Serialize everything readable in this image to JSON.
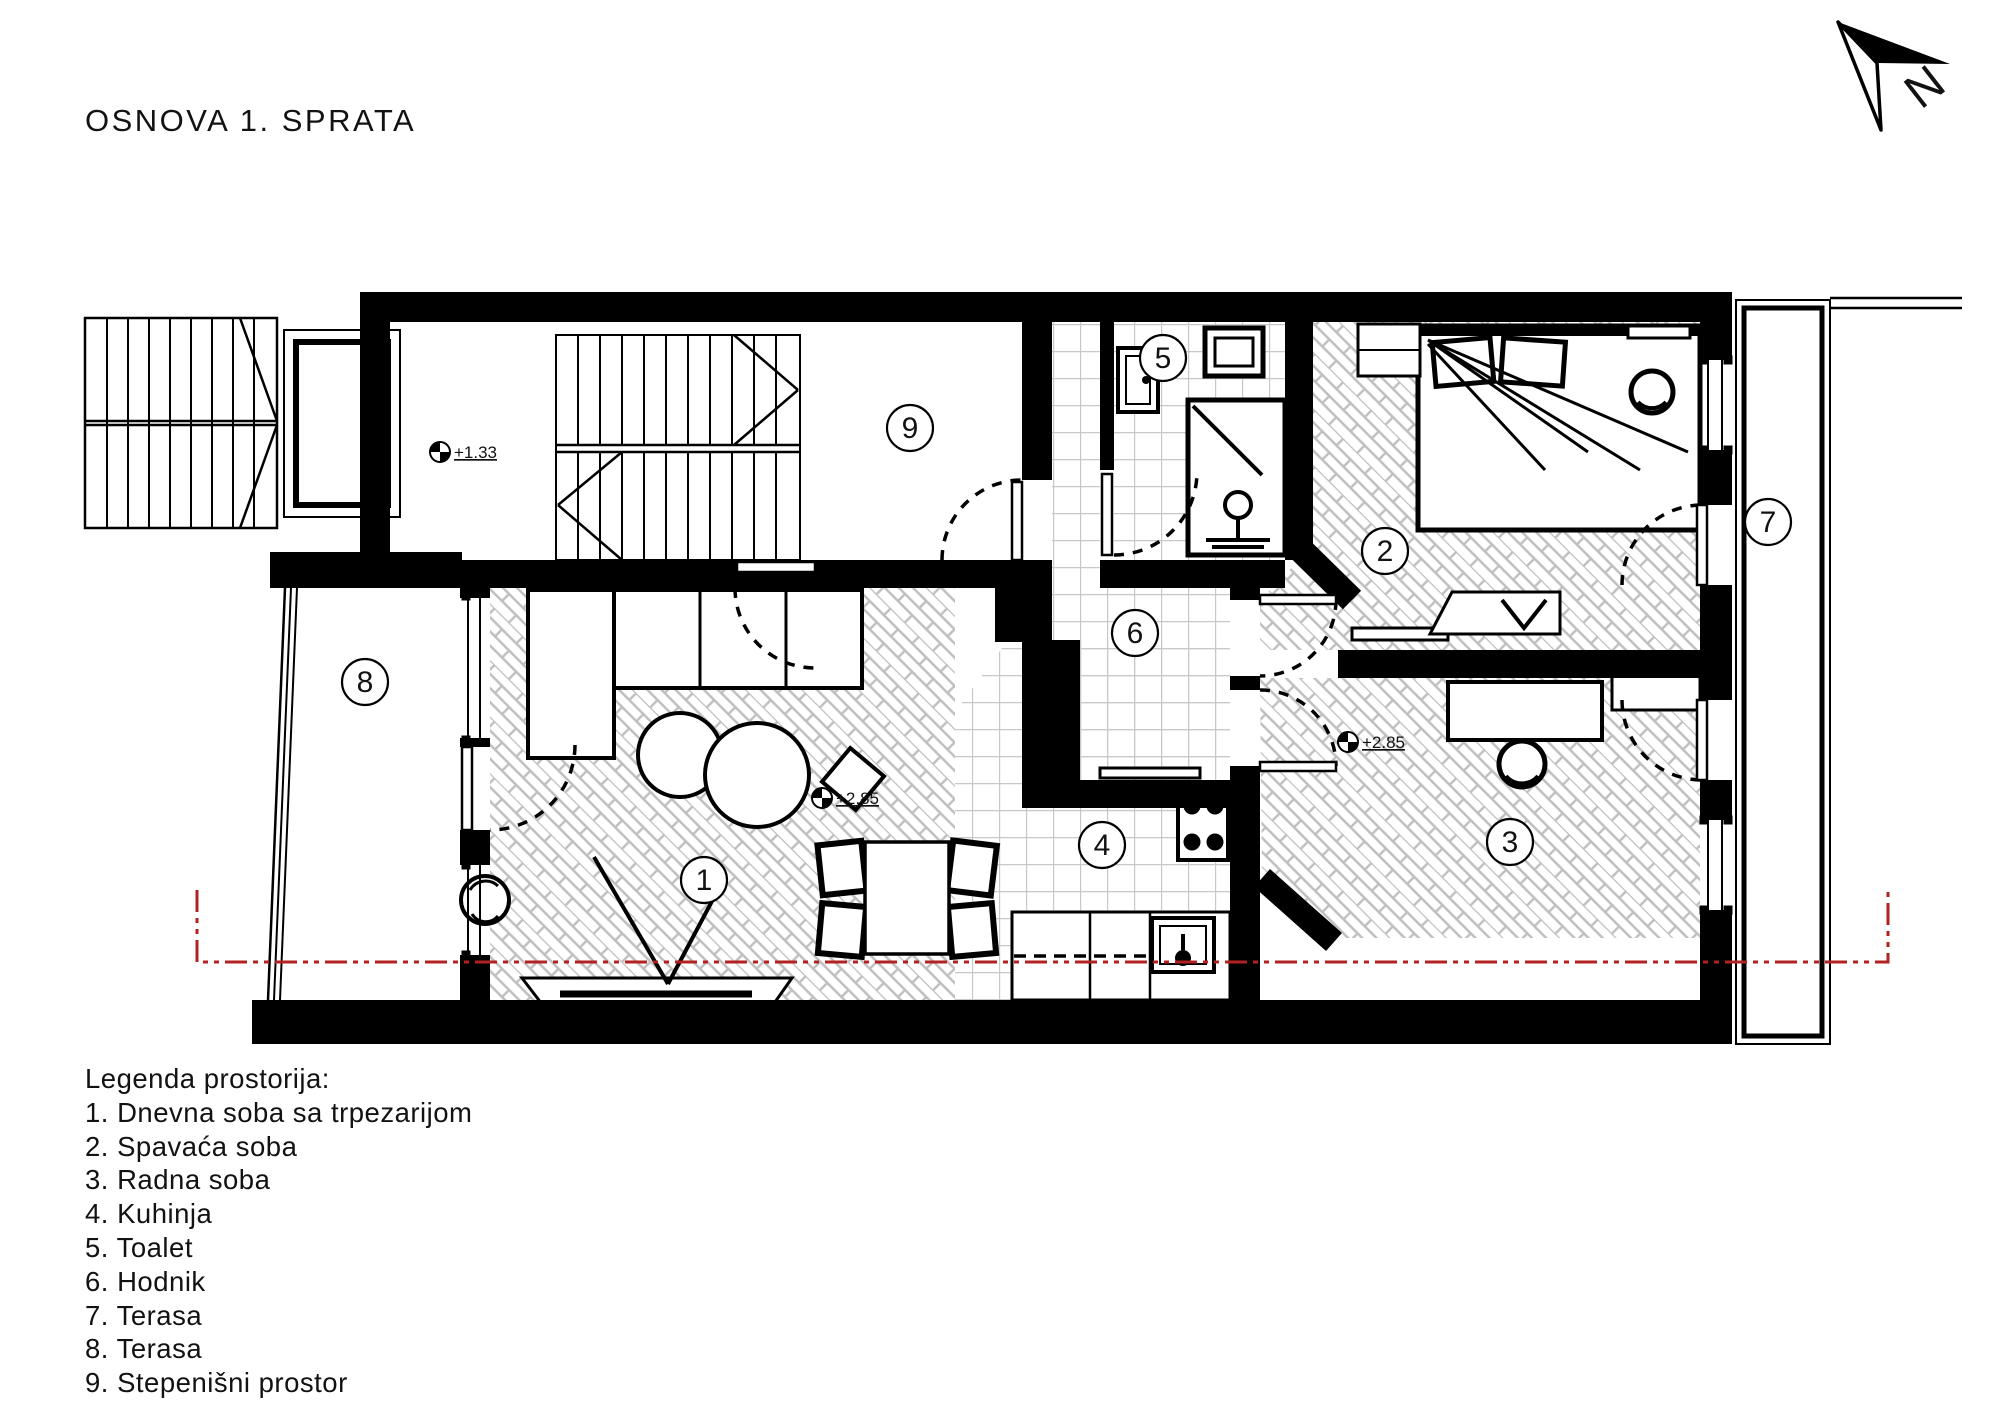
{
  "title": "OSNOVA 1. SPRATA",
  "north": {
    "label": "N"
  },
  "legend": {
    "heading": "Legenda prostorija:",
    "items": [
      "1. Dnevna soba sa trpezarijom",
      "2. Spavaća soba",
      "3. Radna soba",
      "4. Kuhinja",
      "5. Toalet",
      "6. Hodnik",
      "7. Terasa",
      "8. Terasa",
      "9. Stepenišni prostor"
    ]
  },
  "rooms": [
    {
      "number": "1",
      "name": "Dnevna soba sa trpezarijom"
    },
    {
      "number": "2",
      "name": "Spavaća soba"
    },
    {
      "number": "3",
      "name": "Radna soba"
    },
    {
      "number": "4",
      "name": "Kuhinja"
    },
    {
      "number": "5",
      "name": "Toalet"
    },
    {
      "number": "6",
      "name": "Hodnik"
    },
    {
      "number": "7",
      "name": "Terasa"
    },
    {
      "number": "8",
      "name": "Terasa"
    },
    {
      "number": "9",
      "name": "Stepenišni prostor"
    }
  ],
  "level_markers": [
    {
      "value": "+1.33"
    },
    {
      "value": "+2.85"
    },
    {
      "value": "+2.85"
    }
  ],
  "colors": {
    "walls": "#000000",
    "floor_pattern": "#bfbfbf",
    "section_line": "#b22222",
    "background": "#ffffff"
  }
}
